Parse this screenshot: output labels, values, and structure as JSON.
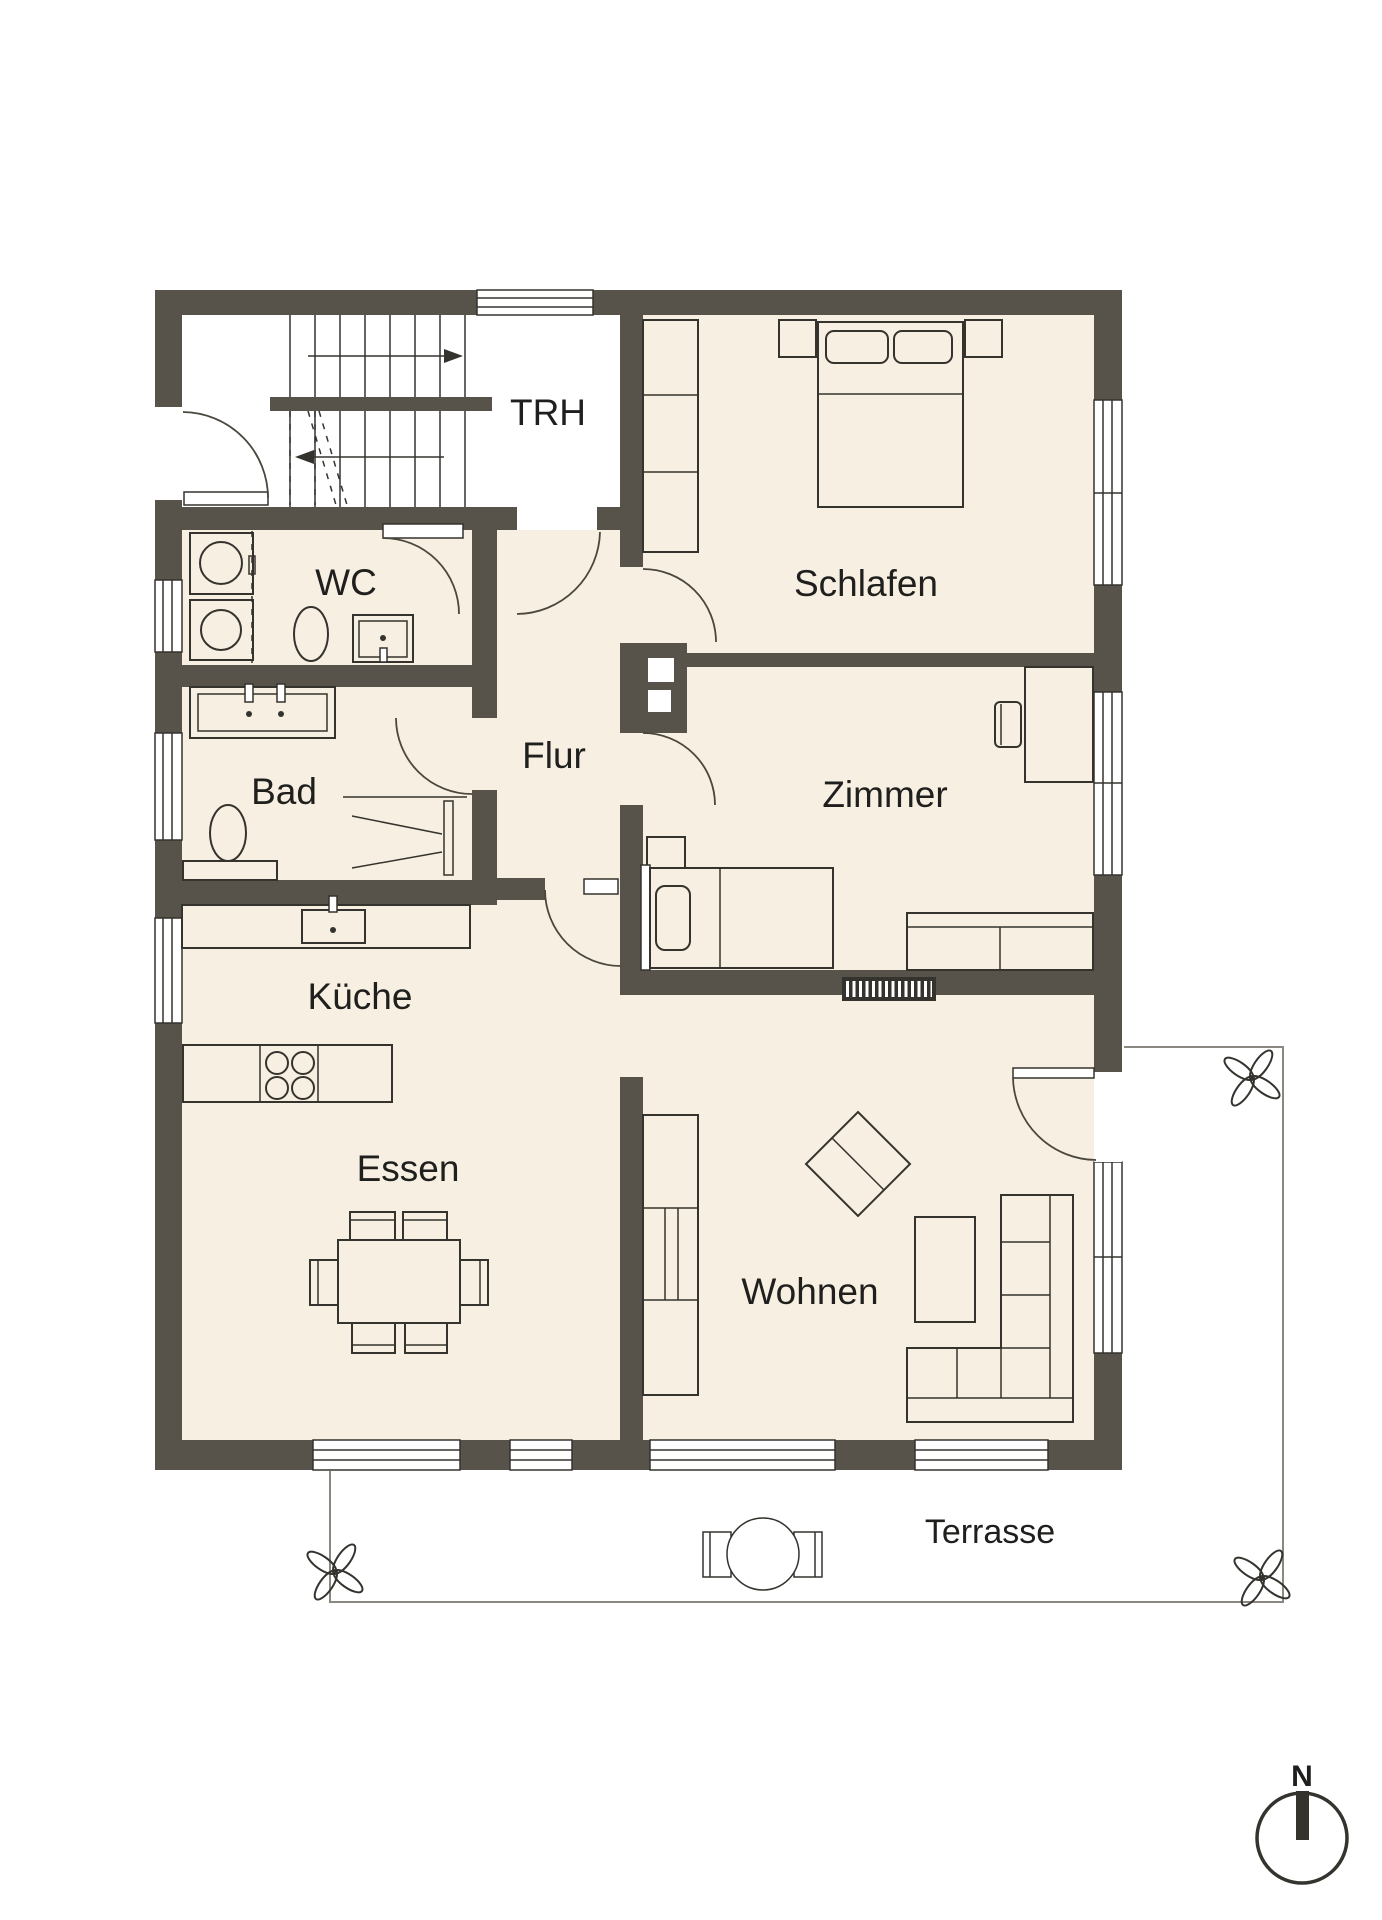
{
  "title": "Grundriss Erdgeschoss Wohnung",
  "colors": {
    "wall": "#57534B",
    "floor": "#F7EFE1",
    "background": "#FFFFFF",
    "line": "#35332E",
    "terrace_outline": "#8A8880",
    "text": "#1F1F1D"
  },
  "rooms": {
    "trh": "TRH",
    "wc": "WC",
    "schlafen": "Schlafen",
    "bad": "Bad",
    "flur": "Flur",
    "zimmer": "Zimmer",
    "kueche": "Küche",
    "essen": "Essen",
    "wohnen": "Wohnen",
    "terrasse": "Terrasse"
  },
  "compass": {
    "north_label": "N"
  },
  "icons": {
    "compass": "compass-north-icon",
    "plant": "flower-plant-icon",
    "stairs_up": "arrow-right-icon",
    "stairs_down": "arrow-left-icon"
  }
}
